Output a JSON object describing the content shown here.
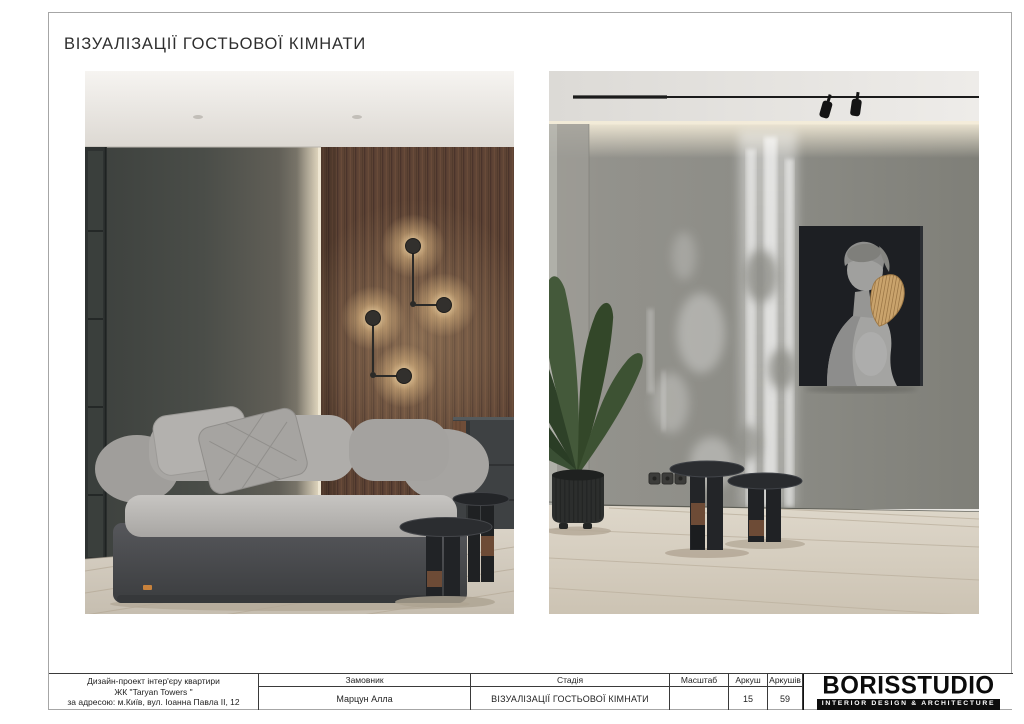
{
  "page": {
    "title": "ВІЗУАЛІЗАЦІЇ ГОСТЬОВОЇ КІМНАТИ"
  },
  "title_block": {
    "project": {
      "line1": "Дизайн-проект інтер'єру квартири",
      "line2": "ЖК \"Taryan Towers \"",
      "line3": "за адресою: м.Київ, вул. Іоанна Павла II, 12"
    },
    "client": {
      "label": "Замовник",
      "value": "Марцун Алла"
    },
    "stage": {
      "label": "Стадія",
      "value": "ВІЗУАЛІЗАЦІЇ ГОСТЬОВОЇ КІМНАТИ"
    },
    "scale": {
      "label": "Масштаб",
      "value": ""
    },
    "sheet": {
      "label": "Аркуш",
      "value": "15"
    },
    "sheets_total": {
      "label": "Аркушів",
      "value": "59"
    },
    "logo": {
      "name": "BORISSTUDIO",
      "tagline": "INTERIOR DESIGN & ARCHITECTURE"
    }
  },
  "colors": {
    "paper": "#ffffff",
    "frame_border": "#a6a6a6",
    "table_border": "#3a3a3a",
    "brand_black": "#0d0d0d",
    "dark_wall": "#454844",
    "wood_wall": "#5d4334",
    "gray_wall": "#8c8c86",
    "lamp_glow": "#ffe9bf",
    "wood_accent": "#6d4b36",
    "mask_gold": "#c9a36c",
    "floor_wood": "#d6cec1",
    "plant_green": "#3a4f34"
  }
}
